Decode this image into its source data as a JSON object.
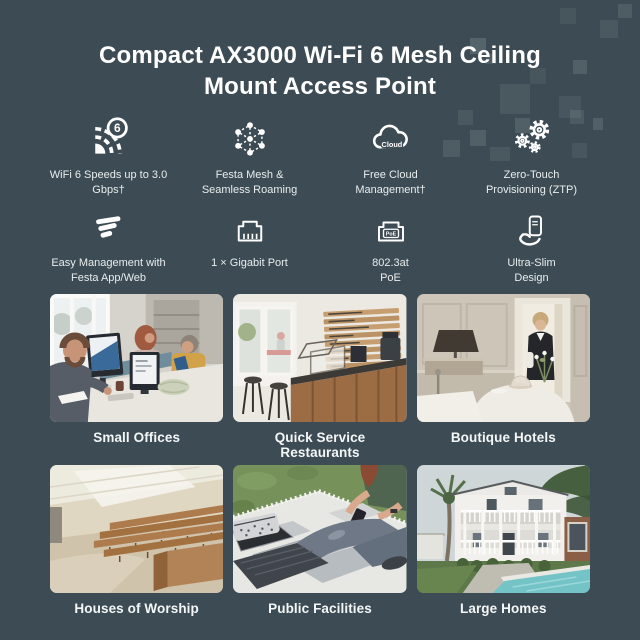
{
  "colors": {
    "background": "#3d4c54",
    "title_text": "#ffffff",
    "feature_label_text": "#e8edee",
    "usecase_label_text": "#f4f7f8",
    "decoration_square": "#e9f0f2",
    "icon_stroke": "#ffffff"
  },
  "title": "Compact AX3000 Wi-Fi 6 Mesh Ceiling Mount Access Point",
  "features": [
    {
      "icon": "wifi-6-icon",
      "badge": "6",
      "label": "WiFi 6 Speeds up to 3.0 Gbps†"
    },
    {
      "icon": "mesh-icon",
      "label": "Festa Mesh & Seamless Roaming"
    },
    {
      "icon": "cloud-icon",
      "icon_text": "Cloud",
      "label": "Free Cloud Management†"
    },
    {
      "icon": "gears-icon",
      "label": "Zero-Touch Provisioning (ZTP)"
    },
    {
      "icon": "festa-logo-icon",
      "label": "Easy Management with Festa App/Web"
    },
    {
      "icon": "ethernet-port-icon",
      "label": "1 × Gigabit Port"
    },
    {
      "icon": "poe-port-icon",
      "icon_text": "PoE",
      "label": "802.3at PoE"
    },
    {
      "icon": "ultra-slim-icon",
      "label": "Ultra-Slim Design"
    }
  ],
  "use_cases": [
    {
      "label": "Small Offices",
      "image": "office-photo"
    },
    {
      "label": "Quick Service Restaurants",
      "image": "cafe-photo"
    },
    {
      "label": "Boutique Hotels",
      "image": "hotel-photo"
    },
    {
      "label": "Houses of Worship",
      "image": "auditorium-photo"
    },
    {
      "label": "Public Facilities",
      "image": "picnic-photo"
    },
    {
      "label": "Large Homes",
      "image": "house-photo"
    }
  ]
}
